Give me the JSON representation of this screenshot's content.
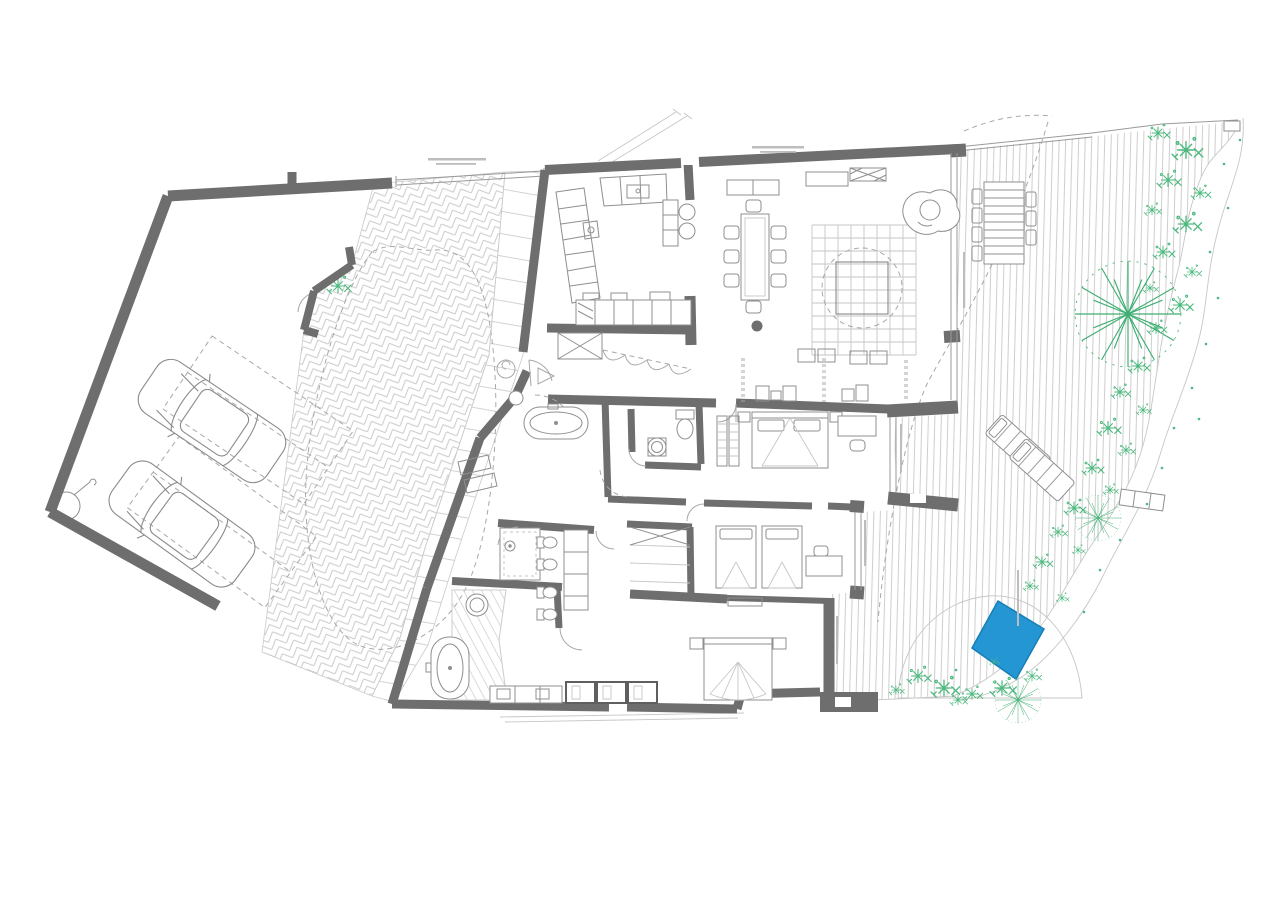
{
  "meta": {
    "kind": "architectural floor plan",
    "view": "top-down site plan of a villa with parking court, dwelling and garden deck"
  },
  "colors": {
    "background": "#ffffff",
    "wall": "#6e6e6e",
    "furniture_line": "#8f8f8f",
    "light_line": "#c6c6c6",
    "dashed_line": "#a8a8a8",
    "paving_line": "#cbcbcb",
    "deck_line": "#cecece",
    "plant": "#4cb97e",
    "palm": "#3fae72",
    "pool": "#2496d3",
    "pool_edge": "#177fb6"
  },
  "zones": [
    {
      "name": "parking-court",
      "contents": [
        "car",
        "car",
        "parking-bay",
        "parking-bay",
        "site-wall",
        "corner-manhole"
      ]
    },
    {
      "name": "driveway",
      "contents": [
        "herringbone-paving",
        "paver-band",
        "dashed-planting-island"
      ]
    },
    {
      "name": "house",
      "contents": [
        "kitchen",
        "dining-area",
        "living-area",
        "bedroom-1",
        "bedroom-2",
        "master-bedroom",
        "family-bathroom",
        "wc",
        "second-bathroom",
        "master-bathroom",
        "hall"
      ]
    },
    {
      "name": "garden-deck",
      "contents": [
        "timber-deck",
        "outdoor-dining-set",
        "sun-loungers",
        "palm-trees",
        "shrubs",
        "winding-path",
        "plunge-pool",
        "garden-bench"
      ]
    }
  ],
  "counts": {
    "cars": 2,
    "parking_bays": 2,
    "dining_chairs": 8,
    "outdoor_dining_chairs": 7,
    "sun_loungers": 2,
    "beds": 4,
    "bathtubs": 2,
    "wall_hung_fixtures": 7,
    "palm_trees": 3,
    "pools": 1,
    "structural_columns": 1
  }
}
